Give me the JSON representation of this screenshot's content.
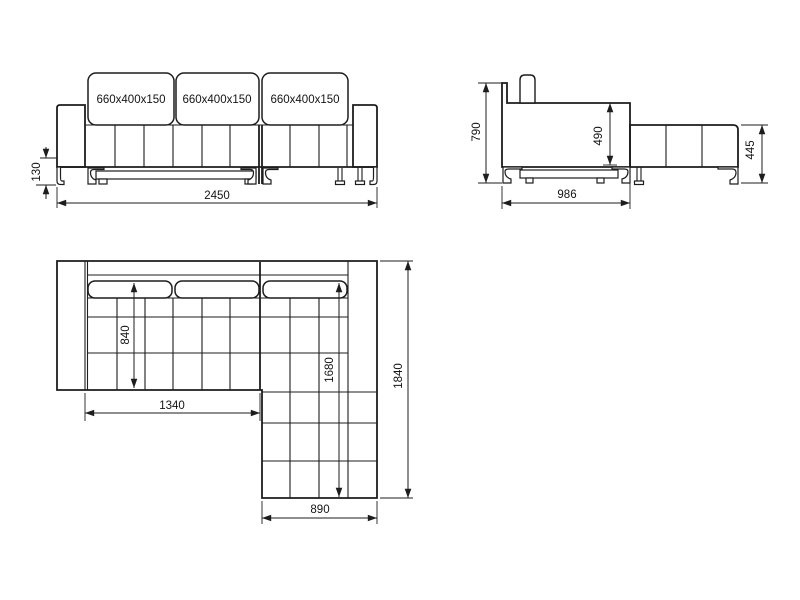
{
  "colors": {
    "line": "#1d1d1d",
    "background": "#ffffff"
  },
  "front_view": {
    "cushions": [
      {
        "label": "660x400x150"
      },
      {
        "label": "660x400x150"
      },
      {
        "label": "660x400x150"
      }
    ],
    "dim_leg_height": "130",
    "dim_total_width": "2450"
  },
  "side_view": {
    "dim_total_height": "790",
    "dim_back_height": "490",
    "dim_depth": "986",
    "dim_chaise_height": "445"
  },
  "plan_view": {
    "dim_seat_depth": "840",
    "dim_seat_width": "1340",
    "dim_chaise_inner_length": "1680",
    "dim_total_length": "1840",
    "dim_chaise_width": "890"
  }
}
